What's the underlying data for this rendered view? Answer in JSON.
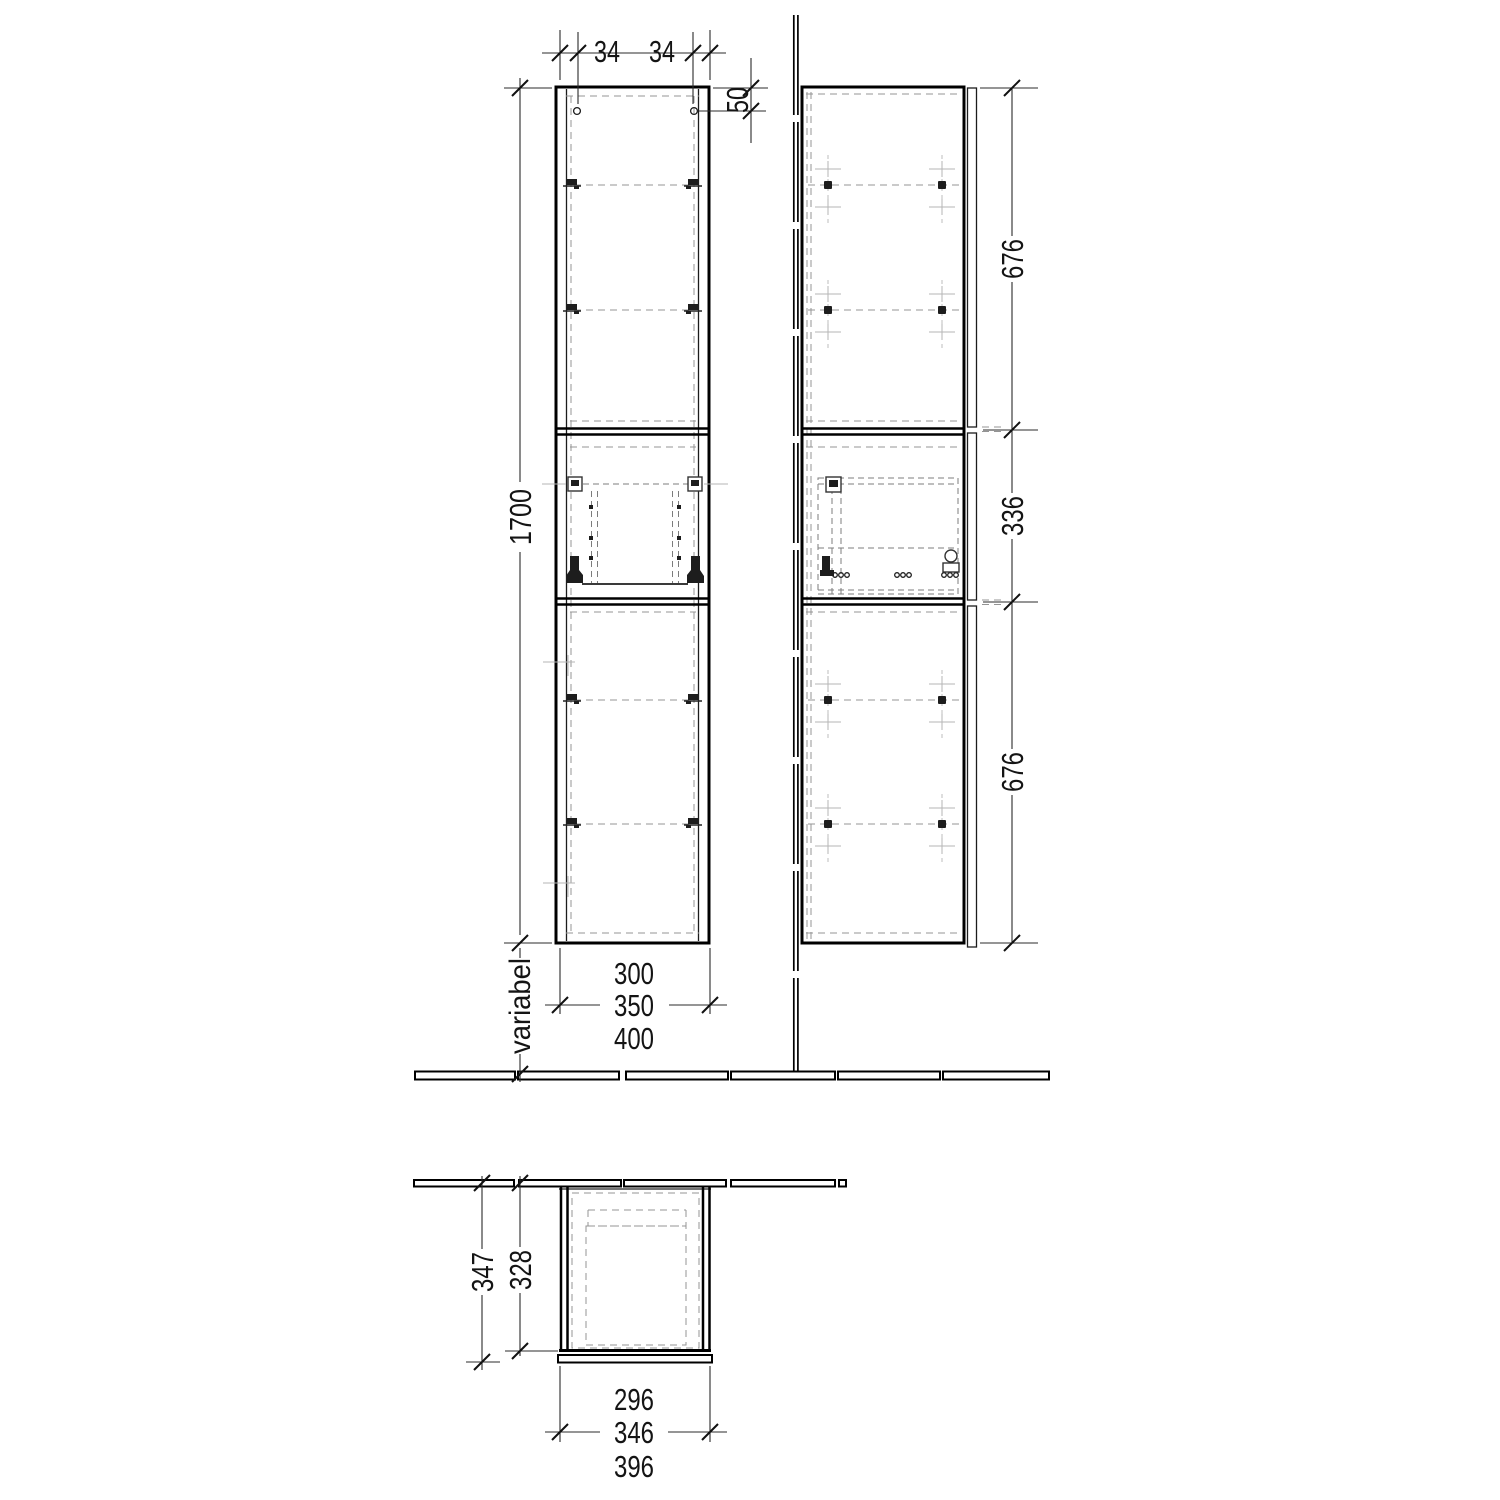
{
  "drawing": {
    "type": "furniture-technical-drawing",
    "views": [
      "front-elevation",
      "side-elevation",
      "plan-view"
    ],
    "dims": {
      "front": {
        "hole_left": "34",
        "hole_right": "34",
        "hole_top": "50",
        "height": "1700",
        "bottom_clearance": "variabel",
        "width_min": "300",
        "width_mid": "350",
        "width_max": "400"
      },
      "side": {
        "top_section": "676",
        "middle_section": "336",
        "bottom_section": "676"
      },
      "plan": {
        "depth_total": "347",
        "depth_carcass": "328",
        "width_inner": "296",
        "width_mid": "346",
        "width_outer": "396"
      }
    }
  }
}
